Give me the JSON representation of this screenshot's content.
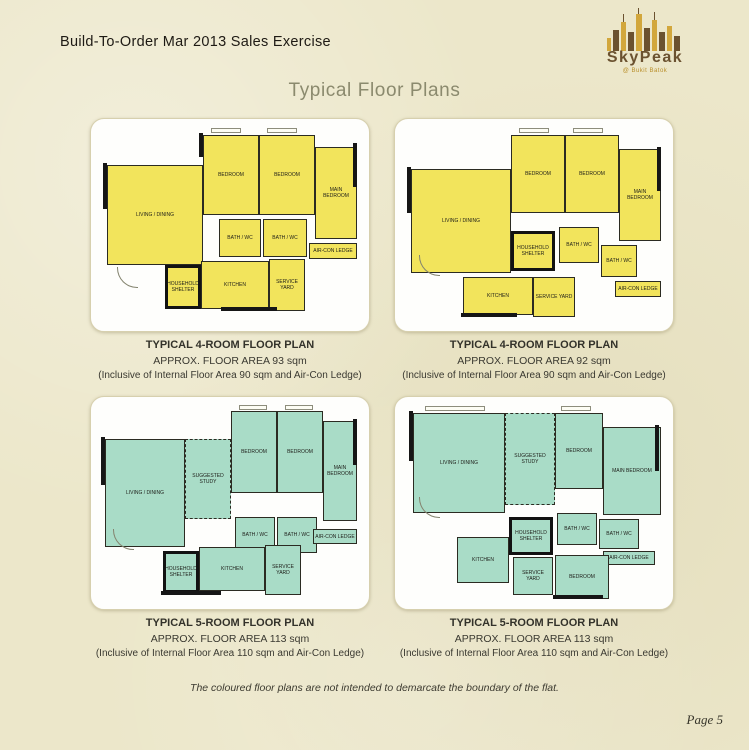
{
  "header": {
    "title": "Build-To-Order Mar 2013 Sales Exercise"
  },
  "logo": {
    "name": "SkyPeak",
    "subtitle": "@ Bukit Batok"
  },
  "page_title": "Typical Floor Plans",
  "colors": {
    "background": "#ece7ca",
    "plan_yellow": "#f2e45c",
    "plan_teal": "#a9dcc7",
    "title_text": "#8b8a6e",
    "logo_brown": "#6b5230",
    "logo_gold": "#d2a73c"
  },
  "plans": [
    {
      "caption": {
        "title": "TYPICAL 4-ROOM FLOOR PLAN",
        "area": "APPROX. FLOOR AREA 93 sqm",
        "inclusive": "(Inclusive of Internal Floor Area 90 sqm and Air-Con Ledge)"
      },
      "color": "#f2e45c",
      "rooms": [
        "LIVING / DINING",
        "BEDROOM",
        "BEDROOM",
        "MAIN BEDROOM",
        "BATH / WC",
        "BATH / WC",
        "AIR-CON LEDGE",
        "HOUSEHOLD SHELTER",
        "KITCHEN",
        "SERVICE YARD"
      ]
    },
    {
      "caption": {
        "title": "TYPICAL 4-ROOM FLOOR PLAN",
        "area": "APPROX. FLOOR AREA 92 sqm",
        "inclusive": "(Inclusive of Internal Floor Area 90 sqm and Air-Con Ledge)"
      },
      "color": "#f2e45c",
      "rooms": [
        "LIVING / DINING",
        "BEDROOM",
        "BEDROOM",
        "MAIN BEDROOM",
        "HOUSEHOLD SHELTER",
        "BATH / WC",
        "BATH / WC",
        "KITCHEN",
        "SERVICE YARD",
        "AIR-CON LEDGE"
      ]
    },
    {
      "caption": {
        "title": "TYPICAL 5-ROOM FLOOR PLAN",
        "area": "APPROX. FLOOR AREA 113 sqm",
        "inclusive": "(Inclusive of Internal Floor Area 110 sqm and Air-Con Ledge)"
      },
      "color": "#a9dcc7",
      "rooms": [
        "LIVING / DINING",
        "SUGGESTED STUDY",
        "BEDROOM",
        "BEDROOM",
        "MAIN BEDROOM",
        "BATH / WC",
        "BATH / WC",
        "AIR-CON LEDGE",
        "HOUSEHOLD SHELTER",
        "KITCHEN",
        "SERVICE YARD"
      ]
    },
    {
      "caption": {
        "title": "TYPICAL 5-ROOM FLOOR PLAN",
        "area": "APPROX. FLOOR AREA 113 sqm",
        "inclusive": "(Inclusive of Internal Floor Area 110 sqm and Air-Con Ledge)"
      },
      "color": "#a9dcc7",
      "rooms": [
        "LIVING / DINING",
        "SUGGESTED STUDY",
        "BEDROOM",
        "MAIN BEDROOM",
        "HOUSEHOLD SHELTER",
        "BATH / WC",
        "BATH / WC",
        "AIR-CON LEDGE",
        "KITCHEN",
        "SERVICE YARD",
        "BEDROOM"
      ]
    }
  ],
  "disclaimer": "The coloured floor plans are not intended to demarcate the boundary of the flat.",
  "page_number": "Page 5"
}
